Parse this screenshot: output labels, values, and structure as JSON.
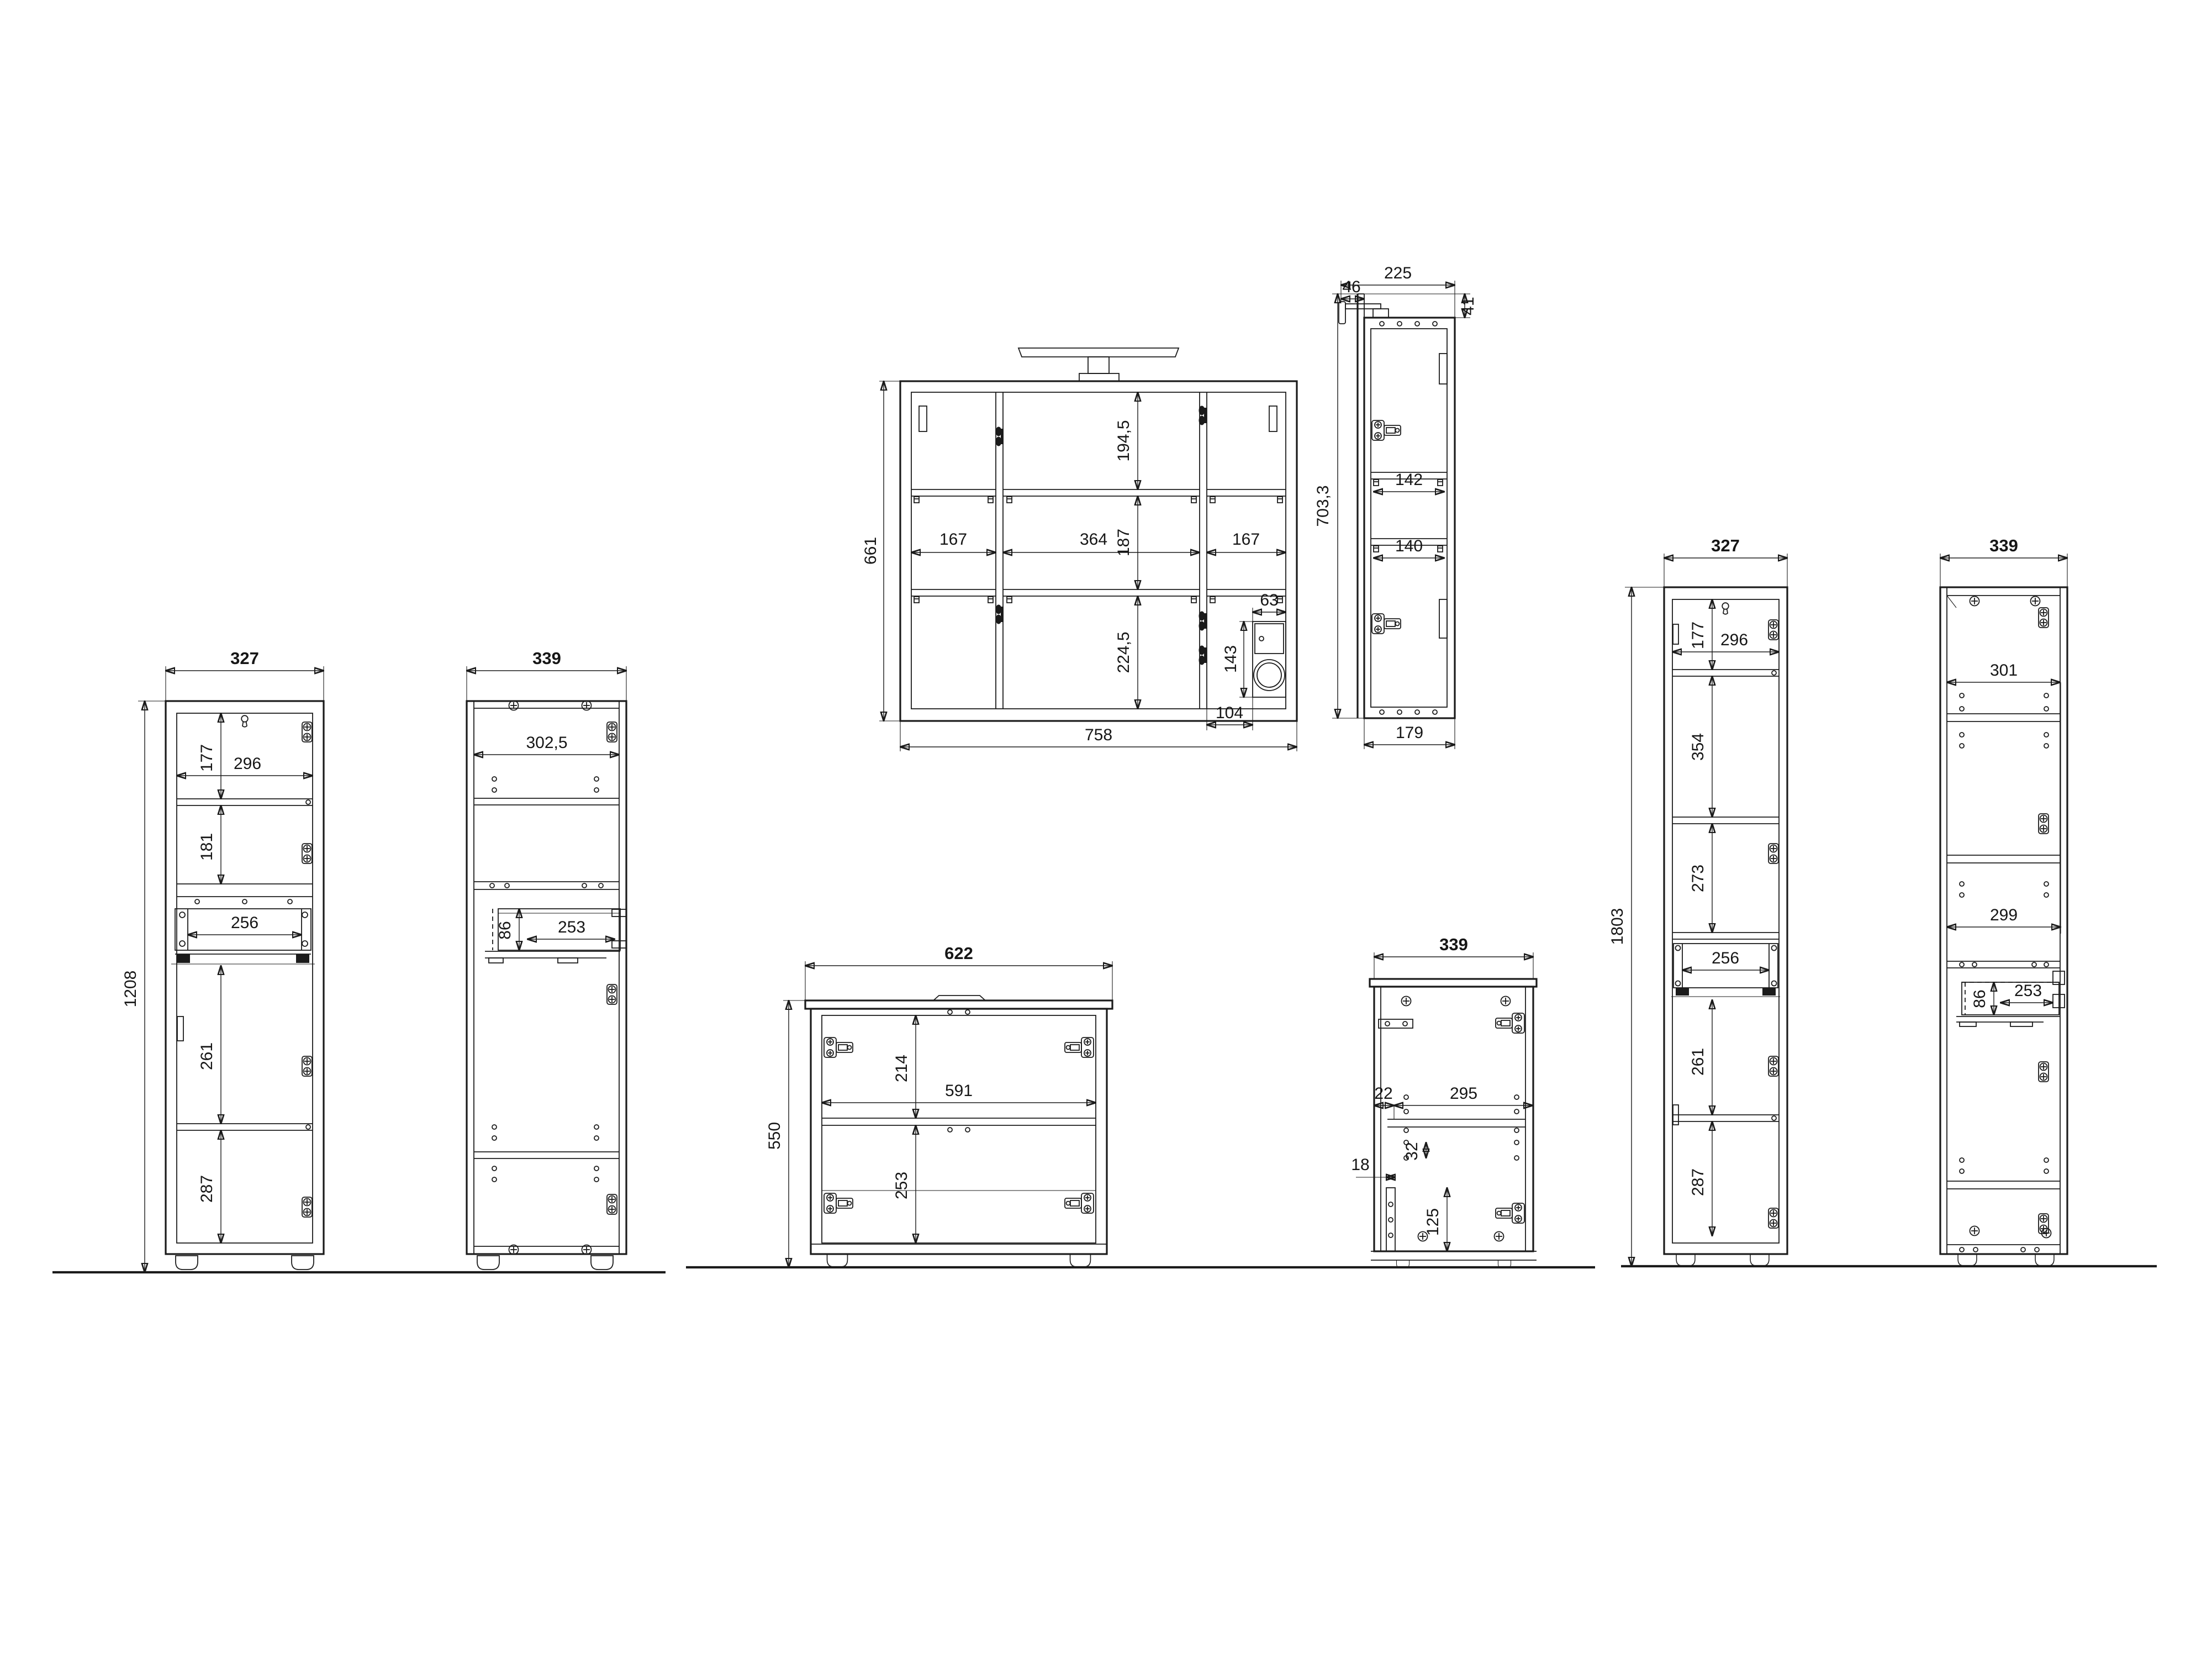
{
  "meta": {
    "background": "#ffffff",
    "ink": "#1b1b1b",
    "sheet_type": "furniture-dimension-drawing"
  },
  "views": {
    "mirror_front": {
      "w": "758",
      "h": "661",
      "col_left": "167",
      "col_mid": "364",
      "col_right": "167",
      "row_top": "194,5",
      "row_mid": "187",
      "row_bottom": "224,5",
      "socket_w": "63",
      "socket_h": "143",
      "socket_off": "104"
    },
    "mirror_side": {
      "depth": "225",
      "lamp": "46",
      "overhang": "41",
      "h": "703,3",
      "shelf_top": "142",
      "shelf_bottom": "140",
      "depth_body": "179"
    },
    "tall_front": {
      "w": "327",
      "h": "1208",
      "sec1": "177",
      "inner_w": "296",
      "sec2": "181",
      "drawer_w": "256",
      "sec3": "261",
      "sec4": "287"
    },
    "tall_side": {
      "w": "339",
      "inner_w": "302,5",
      "drawer_h": "86",
      "drawer_d": "253"
    },
    "vanity_front": {
      "w": "622",
      "h": "550",
      "sec1": "214",
      "inner_w": "591",
      "sec2": "253"
    },
    "vanity_side": {
      "w": "339",
      "gap_front": "22",
      "shelf_d": "295",
      "hole_gap": "32",
      "rail_w": "18",
      "rail_h": "125"
    },
    "xtall_front": {
      "w": "327",
      "h": "1803",
      "sec1": "177",
      "inner_w": "296",
      "sec2": "354",
      "sec3": "273",
      "drawer_w": "256",
      "sec4": "261",
      "sec5": "287"
    },
    "xtall_side": {
      "w": "339",
      "inner_top": "301",
      "inner_mid": "299",
      "drawer_h": "86",
      "drawer_d": "253"
    }
  }
}
